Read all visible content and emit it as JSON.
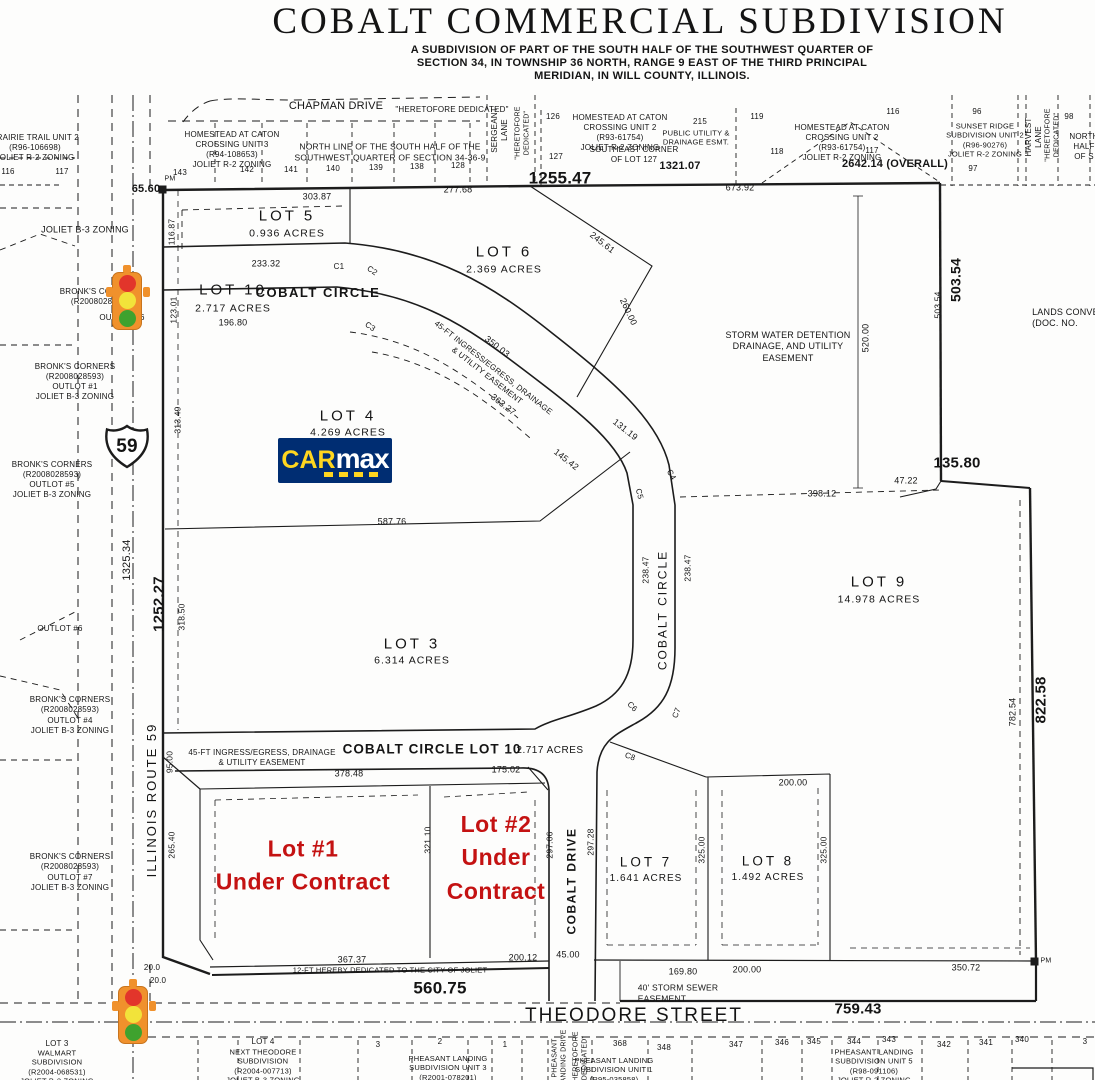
{
  "header": {
    "title": "COBALT COMMERCIAL SUBDIVISION",
    "subtitle1": "A SUBDIVISION OF PART OF THE SOUTH HALF OF THE SOUTHWEST QUARTER OF",
    "subtitle2": "SECTION 34, IN TOWNSHIP 36 NORTH, RANGE 9 EAST OF THE THIRD PRINCIPAL",
    "subtitle3": "MERIDIAN, IN WILL COUNTY, ILLINOIS."
  },
  "roads": {
    "chapman": "CHAPMAN DRIVE",
    "theodore": "THEODORE STREET",
    "il59": "ILLINOIS ROUTE 59",
    "cobalt_circle": "COBALT CIRCLE",
    "cobalt_drive": "COBALT DRIVE",
    "sergeant": "SERGEANT\nLANE",
    "harvest": "HARVEST\nLANE",
    "pheasant_drive": "PHEASANT\nLANDING DRIVE",
    "dedicated_q": "\"HERETOFORE DEDICATED\"",
    "dedicated_v": "\"HERETOFORE\nDEDICATED\"",
    "shield_number": "59"
  },
  "lots": {
    "lot3": {
      "n": "LOT 3",
      "a": "6.314 ACRES"
    },
    "lot4": {
      "n": "LOT 4",
      "a": "4.269 ACRES"
    },
    "lot5": {
      "n": "LOT 5",
      "a": "0.936 ACRES"
    },
    "lot6": {
      "n": "LOT 6",
      "a": "2.369 ACRES"
    },
    "lot7": {
      "n": "LOT 7",
      "a": "1.641 ACRES"
    },
    "lot8": {
      "n": "LOT 8",
      "a": "1.492 ACRES"
    },
    "lot9": {
      "n": "LOT 9",
      "a": "14.978 ACRES"
    },
    "lot10": {
      "n": "LOT 10",
      "a": "2.717 ACRES"
    },
    "strip": {
      "n": "COBALT CIRCLE LOT 10",
      "a": "2.717 ACRES"
    }
  },
  "contracts": {
    "lot1": "Lot #1\nUnder Contract",
    "lot2": "Lot #2\nUnder\nContract"
  },
  "easements": {
    "ingress": "45-FT INGRESS/EGRESS, DRAINAGE\n& UTILITY EASEMENT",
    "storm_water": "STORM WATER DETENTION\nDRAINAGE, AND UTILITY\nEASEMENT",
    "storm_sewer": "40' STORM SEWER\nEASEMENT",
    "public_util": "PUBLIC UTILITY &\nDRAINAGE ESMT.",
    "dedication12": "12-FT HEREBY DEDICATED TO THE CITY OF JOLIET",
    "north_line": "NORTH LINE OF THE SOUTH HALF OF THE\nSOUTHWEST QUARTER OF SECTION 34-36-9",
    "se_corner": "SOUTHEAST CORNER\nOF LOT 127"
  },
  "surround": {
    "prairie": "PRAIRIE TRAIL UNIT 2\n(R96-106698)\nJOLIET R-2 ZONING",
    "homestead3": "HOMESTEAD AT CATON\nCROSSING UNIT 3\n(R94-108653)\nJOLIET R-2 ZONING",
    "homestead2": "HOMESTEAD AT CATON\nCROSSING UNIT 2\n(R93-61754)\nJOLIET R-2 ZONING",
    "sunset": "SUNSET RIDGE\nSUBDIVISION UNIT 2\n(R96-90276)\nJOLIET R-2 ZONING",
    "north_half": "NORTH\nHALF\nOF S",
    "lands": "LANDS CONVEYED\n(DOC. NO.",
    "joliet_b3": "JOLIET B-3 ZONING",
    "bronks": "BRONK'S CORNERS\n(R2008028593)",
    "outlot1": "OUTLOT #1\nJOLIET B-3 ZONING",
    "outlot4": "OUTLOT #4\nJOLIET B-3 ZONING",
    "outlot5": "OUTLOT #5\nJOLIET B-3 ZONING",
    "outlot6": "OUTLOT #6",
    "outlot7": "OUTLOT #7\nJOLIET B-3 ZONING",
    "walmart_lot": "LOT 3",
    "walmart": "WALMART\nSUBDIVISION\n(R2004-068531)\nJOLIET B-3 ZONING",
    "next_theodore_lot": "LOT 4",
    "next_theodore": "NEXT THEODORE\nSUBDIVISION\n(R2004-007713)\nJOLIET B-3 ZONING",
    "pheasant1": "PHEASANT LANDING\nSUBDIVISION UNIT 1\n(R95-035858)",
    "pheasant3": "PHEASANT LANDING\nSUBDIVISION UNIT 3\n(R2001-078201)",
    "pheasant5": "PHEASANT LANDING\nSUBDIVISION UNIT 5\n(R98-091106)\nJOLIET R-2 ZONING"
  },
  "parcels": {
    "n96": "96",
    "n97": "97",
    "n98": "98",
    "n116": "116",
    "n117": "117",
    "n118": "118",
    "n119": "119",
    "n126": "126",
    "n127": "127",
    "n128": "128",
    "n215": "215",
    "top_row": [
      "143",
      "142",
      "141",
      "140",
      "139",
      "138",
      "128"
    ],
    "unit3_row": [
      "3",
      "2",
      "1"
    ],
    "bottom_row": [
      "368",
      "348",
      "347",
      "346",
      "345",
      "344",
      "343",
      "342",
      "341",
      "340",
      "3"
    ]
  },
  "dims": {
    "d65_60": "65.60",
    "d303_87": "303.87",
    "d277_68": "277.68",
    "d1255_47": "1255.47",
    "d1321_07": "1321.07",
    "d673_92": "673.92",
    "d2642_14": "2642.14 (OVERALL)",
    "d116_87": "116.87",
    "d233_32": "233.32",
    "d123_01": "123.01",
    "d196_80": "196.80",
    "d245_61": "245.61",
    "d260_00": "260.00",
    "d350_03": "350.03",
    "d363_27": "363.27",
    "d313_49": "313.49",
    "d131_19": "131.19",
    "d145_42": "145.42",
    "d587_76": "587.76",
    "d520_00": "520.00",
    "d503_54": "503.54",
    "d135_80": "135.80",
    "d47_22": "47.22",
    "d398_12": "398.12",
    "d238_47": "238.47",
    "d1325_34": "1325.34",
    "d1252_27": "1252.27",
    "d318_50": "318.50",
    "d782_54": "782.54",
    "d822_58": "822.58",
    "d95_00": "95.00",
    "d265_40": "265.40",
    "d378_48": "378.48",
    "d175_02": "175.02",
    "d321_10": "321.10",
    "d297_06": "297.06",
    "d297_28": "297.28",
    "d325_00": "325.00",
    "d200_00": "200.00",
    "d367_37": "367.37",
    "d200_12": "200.12",
    "d45_00": "45.00",
    "d169_80": "169.80",
    "d350_72": "350.72",
    "d560_75": "560.75",
    "d759_43": "759.43",
    "d20_0": "20.0",
    "c1": "C1",
    "c2": "C2",
    "c3": "C3",
    "c4": "C4",
    "c5": "C5",
    "c6": "C6",
    "c7": "C7",
    "c8": "C8",
    "pm": "PM"
  },
  "carmax": {
    "car": "CAR",
    "max": "max"
  }
}
